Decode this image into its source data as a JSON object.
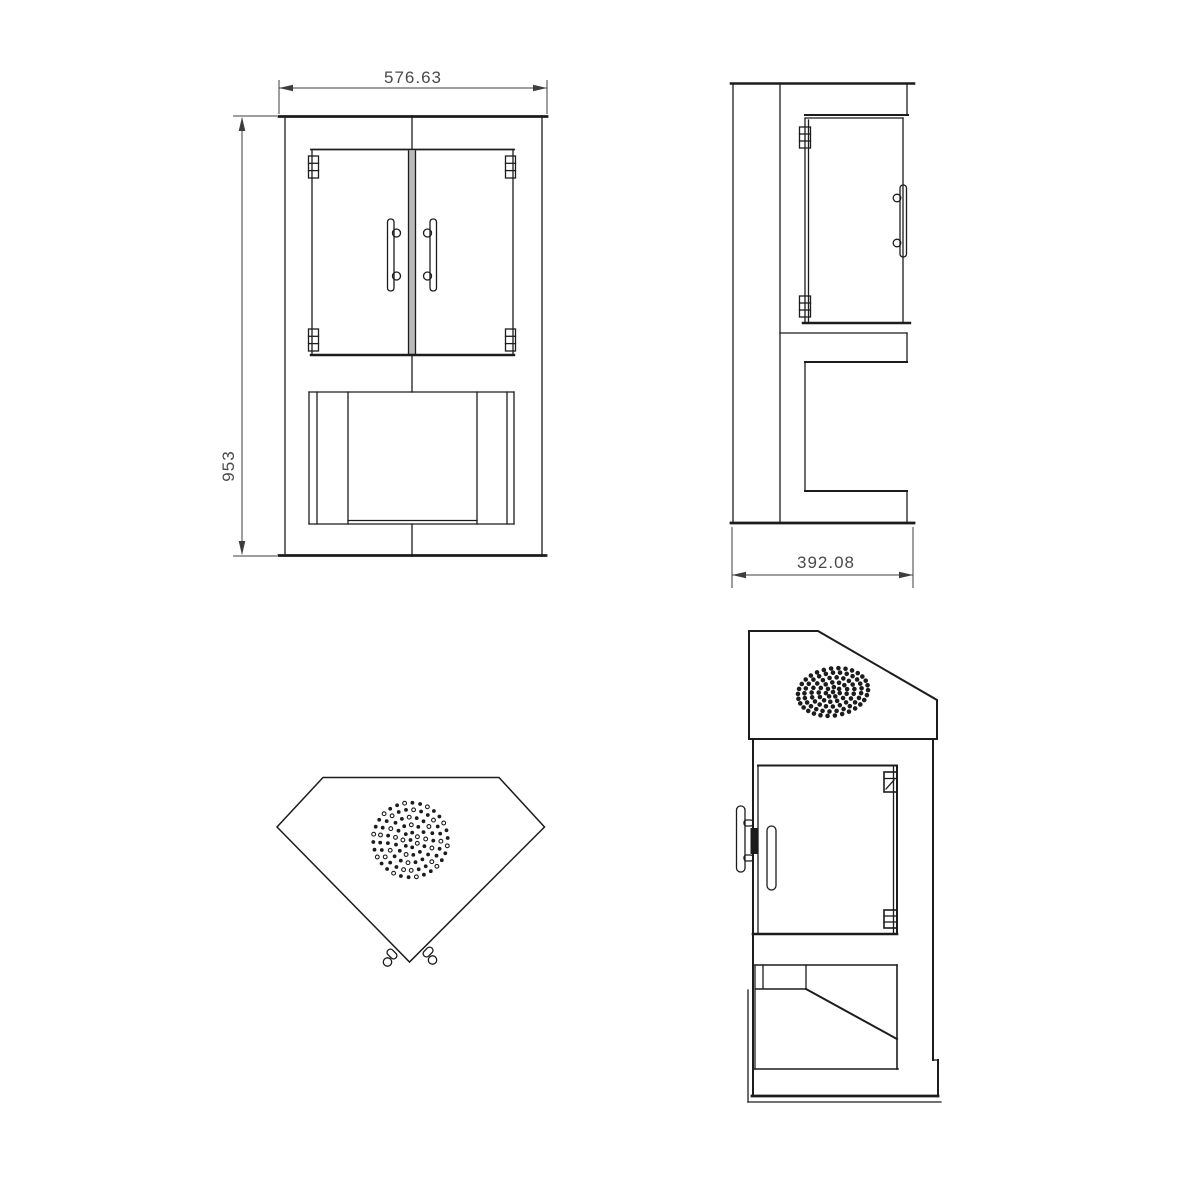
{
  "page": {
    "background": "#ffffff",
    "line_color": "#1c1c1c",
    "dimension_text_color": "#4a4a4a"
  },
  "dimensions": {
    "front_width": "576.63",
    "front_height": "953",
    "side_depth": "392.08"
  }
}
